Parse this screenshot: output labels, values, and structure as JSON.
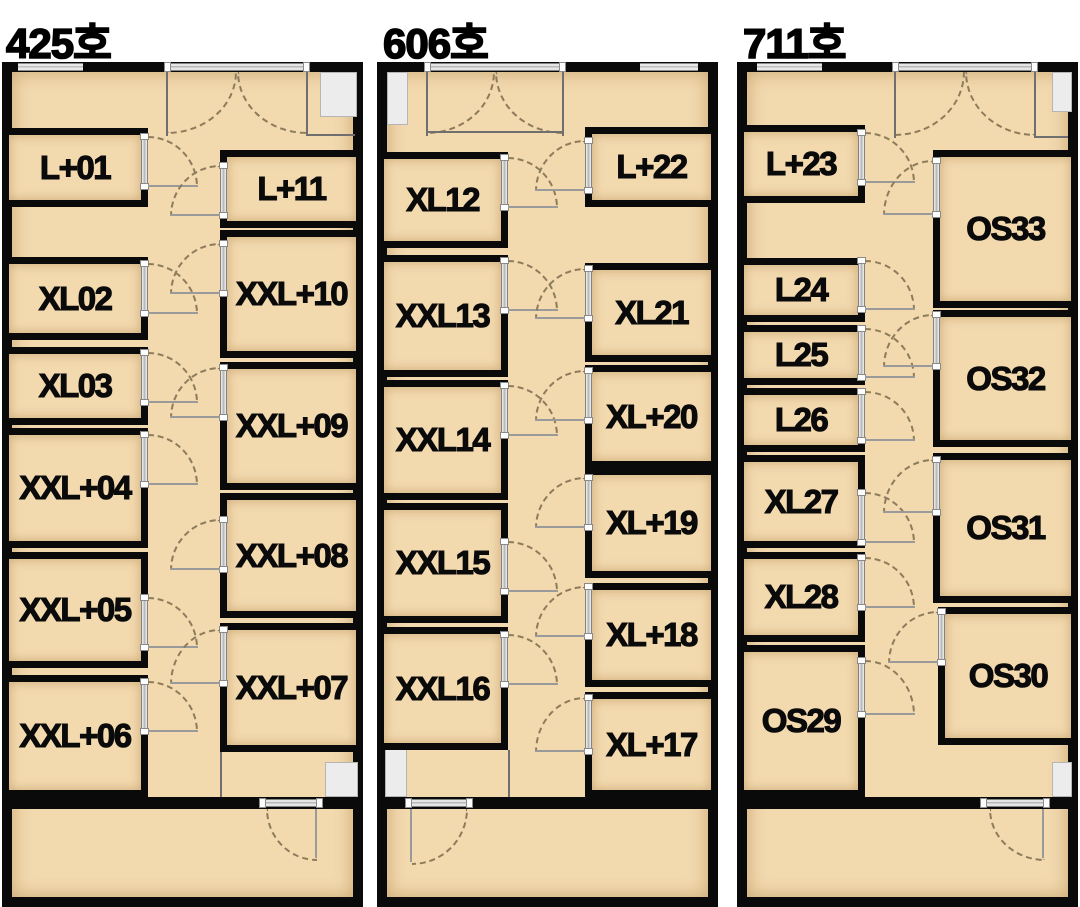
{
  "image_title": "floor-plans",
  "colors": {
    "background": "#ffffff",
    "wall": "#0a0a0a",
    "floor": "#f2d9ae",
    "window_gray": "#e9e9e9",
    "fixture_gray": "#ececec",
    "door_arc": "#8d7c5c",
    "label": "#0a0a0a"
  },
  "units": [
    {
      "title": "425호",
      "frame": {
        "x": 2,
        "y": 62,
        "w": 361,
        "h": 845
      },
      "title_pos": {
        "x": 6,
        "y": 10
      },
      "windows": [
        {
          "x": 18,
          "w": 65
        }
      ],
      "entry": {
        "x1": 167,
        "x2": 307,
        "arc_h": 62,
        "jamb_len": 64
      },
      "entry_hline": {
        "x": 307,
        "y": 134,
        "w": 48
      },
      "fixtures": [
        {
          "x": 320,
          "y": 72,
          "w": 37,
          "h": 45
        },
        {
          "x": 325,
          "y": 762,
          "w": 33,
          "h": 35
        }
      ],
      "corridor_lines": [
        {
          "x": 220,
          "y": 752,
          "w": 2,
          "h": 45
        }
      ],
      "divider": {
        "y": 797,
        "h": 12,
        "door_x1": 262,
        "door_x2": 320,
        "swing": "bl",
        "leaf_x": 315,
        "arc": {
          "x": 266,
          "y": 809,
          "w": 51,
          "h": 52
        }
      },
      "rooms": [
        {
          "label": "L+01",
          "x": 2,
          "y": 128,
          "w": 146,
          "h": 79,
          "side": "left",
          "door": {
            "y": 136,
            "h": 51
          }
        },
        {
          "label": "XL02",
          "x": 2,
          "y": 257,
          "w": 146,
          "h": 83,
          "side": "left",
          "door": {
            "y": 263,
            "h": 51
          }
        },
        {
          "label": "XL03",
          "x": 2,
          "y": 347,
          "w": 146,
          "h": 78,
          "side": "left",
          "door": {
            "y": 352,
            "h": 51
          }
        },
        {
          "label": "XXL+04",
          "x": 2,
          "y": 428,
          "w": 146,
          "h": 120,
          "side": "left",
          "door": {
            "y": 434,
            "h": 51
          }
        },
        {
          "label": "XXL+05",
          "x": 2,
          "y": 552,
          "w": 146,
          "h": 116,
          "side": "left",
          "door": {
            "y": 597,
            "h": 51
          }
        },
        {
          "label": "XXL+06",
          "x": 2,
          "y": 675,
          "w": 146,
          "h": 122,
          "side": "left",
          "door": {
            "y": 681,
            "h": 51
          }
        },
        {
          "label": "L+11",
          "x": 220,
          "y": 150,
          "w": 143,
          "h": 78,
          "side": "right",
          "door": {
            "y": 165,
            "h": 51
          }
        },
        {
          "label": "XXL+10",
          "x": 220,
          "y": 230,
          "w": 143,
          "h": 128,
          "side": "right",
          "door": {
            "y": 243,
            "h": 51
          }
        },
        {
          "label": "XXL+09",
          "x": 220,
          "y": 362,
          "w": 143,
          "h": 128,
          "side": "right",
          "door": {
            "y": 367,
            "h": 51
          }
        },
        {
          "label": "XXL+08",
          "x": 220,
          "y": 493,
          "w": 143,
          "h": 125,
          "side": "right",
          "door": {
            "y": 519,
            "h": 51
          }
        },
        {
          "label": "XXL+07",
          "x": 220,
          "y": 623,
          "w": 143,
          "h": 129,
          "side": "right",
          "door": {
            "y": 629,
            "h": 55
          }
        }
      ]
    },
    {
      "title": "606호",
      "frame": {
        "x": 377,
        "y": 62,
        "w": 341,
        "h": 845
      },
      "title_pos": {
        "x": 383,
        "y": 10
      },
      "windows": [
        {
          "x": 640,
          "w": 58
        }
      ],
      "entry": {
        "x1": 427,
        "x2": 563,
        "arc_h": 62,
        "jamb_len": 64
      },
      "entry_hline": {
        "x": 427,
        "y": 131,
        "w": 136
      },
      "fixtures": [
        {
          "x": 387,
          "y": 72,
          "w": 21,
          "h": 53
        },
        {
          "x": 385,
          "y": 748,
          "w": 22,
          "h": 49
        }
      ],
      "corridor_lines": [
        {
          "x": 508,
          "y": 750,
          "w": 2,
          "h": 47
        }
      ],
      "divider": {
        "y": 797,
        "h": 12,
        "door_x1": 408,
        "door_x2": 470,
        "swing": "br",
        "leaf_x": 410,
        "arc": {
          "x": 412,
          "y": 809,
          "w": 56,
          "h": 56
        }
      },
      "rooms": [
        {
          "label": "XL12",
          "x": 377,
          "y": 152,
          "w": 131,
          "h": 96,
          "side": "left",
          "door": {
            "y": 157,
            "h": 51
          }
        },
        {
          "label": "XXL13",
          "x": 377,
          "y": 255,
          "w": 131,
          "h": 122,
          "side": "left",
          "door": {
            "y": 260,
            "h": 51
          }
        },
        {
          "label": "XXL14",
          "x": 377,
          "y": 380,
          "w": 131,
          "h": 120,
          "side": "left",
          "door": {
            "y": 385,
            "h": 51
          }
        },
        {
          "label": "XXL15",
          "x": 377,
          "y": 503,
          "w": 131,
          "h": 120,
          "side": "left",
          "door": {
            "y": 541,
            "h": 51
          }
        },
        {
          "label": "XXL16",
          "x": 377,
          "y": 627,
          "w": 131,
          "h": 123,
          "side": "left",
          "door": {
            "y": 634,
            "h": 51
          }
        },
        {
          "label": "L+22",
          "x": 585,
          "y": 127,
          "w": 133,
          "h": 80,
          "side": "right",
          "door": {
            "y": 140,
            "h": 51
          }
        },
        {
          "label": "XL21",
          "x": 585,
          "y": 263,
          "w": 133,
          "h": 99,
          "side": "right",
          "door": {
            "y": 268,
            "h": 51
          }
        },
        {
          "label": "XL+20",
          "x": 585,
          "y": 365,
          "w": 133,
          "h": 103,
          "side": "right",
          "door": {
            "y": 370,
            "h": 51
          }
        },
        {
          "label": "XL+19",
          "x": 585,
          "y": 468,
          "w": 133,
          "h": 110,
          "side": "right",
          "door": {
            "y": 477,
            "h": 51
          }
        },
        {
          "label": "XL+18",
          "x": 585,
          "y": 583,
          "w": 133,
          "h": 104,
          "side": "right",
          "door": {
            "y": 586,
            "h": 51
          }
        },
        {
          "label": "XL+17",
          "x": 585,
          "y": 692,
          "w": 133,
          "h": 105,
          "side": "right",
          "door": {
            "y": 697,
            "h": 55
          }
        }
      ]
    },
    {
      "title": "711호",
      "frame": {
        "x": 737,
        "y": 62,
        "w": 341,
        "h": 845
      },
      "title_pos": {
        "x": 743,
        "y": 10
      },
      "windows": [
        {
          "x": 757,
          "w": 65
        }
      ],
      "entry": {
        "x1": 895,
        "x2": 1035,
        "arc_h": 64,
        "jamb_len": 66
      },
      "entry_hline": {
        "x": 1035,
        "y": 136,
        "w": 33
      },
      "fixtures": [
        {
          "x": 1052,
          "y": 72,
          "w": 20,
          "h": 40
        },
        {
          "x": 1052,
          "y": 762,
          "w": 20,
          "h": 35
        }
      ],
      "corridor_lines": [],
      "divider": {
        "y": 797,
        "h": 12,
        "door_x1": 983,
        "door_x2": 1047,
        "swing": "bl",
        "leaf_x": 1042,
        "arc": {
          "x": 989,
          "y": 809,
          "w": 56,
          "h": 52
        }
      },
      "rooms": [
        {
          "label": "L+23",
          "x": 737,
          "y": 125,
          "w": 128,
          "h": 78,
          "side": "left",
          "door": {
            "y": 132,
            "h": 51
          }
        },
        {
          "label": "L24",
          "x": 737,
          "y": 258,
          "w": 128,
          "h": 64,
          "side": "left",
          "door": {
            "y": 260,
            "h": 50
          }
        },
        {
          "label": "L25",
          "x": 737,
          "y": 325,
          "w": 128,
          "h": 60,
          "side": "left",
          "door": {
            "y": 328,
            "h": 50
          }
        },
        {
          "label": "L26",
          "x": 737,
          "y": 388,
          "w": 128,
          "h": 64,
          "side": "left",
          "door": {
            "y": 391,
            "h": 50
          }
        },
        {
          "label": "XL27",
          "x": 737,
          "y": 455,
          "w": 128,
          "h": 93,
          "side": "left",
          "door": {
            "y": 492,
            "h": 51
          }
        },
        {
          "label": "XL28",
          "x": 737,
          "y": 552,
          "w": 128,
          "h": 90,
          "side": "left",
          "door": {
            "y": 557,
            "h": 51
          }
        },
        {
          "label": "OS29",
          "x": 737,
          "y": 645,
          "w": 128,
          "h": 152,
          "side": "left",
          "door": {
            "y": 660,
            "h": 55
          }
        },
        {
          "label": "OS33",
          "x": 933,
          "y": 150,
          "w": 145,
          "h": 158,
          "side": "right",
          "door": {
            "y": 160,
            "h": 55
          }
        },
        {
          "label": "OS32",
          "x": 933,
          "y": 310,
          "w": 145,
          "h": 137,
          "side": "right",
          "door": {
            "y": 314,
            "h": 53
          }
        },
        {
          "label": "OS31",
          "x": 933,
          "y": 453,
          "w": 145,
          "h": 150,
          "side": "right",
          "door": {
            "y": 459,
            "h": 54
          }
        },
        {
          "label": "OS30",
          "x": 938,
          "y": 607,
          "w": 140,
          "h": 138,
          "side": "right",
          "door": {
            "y": 611,
            "h": 52
          }
        }
      ]
    }
  ]
}
